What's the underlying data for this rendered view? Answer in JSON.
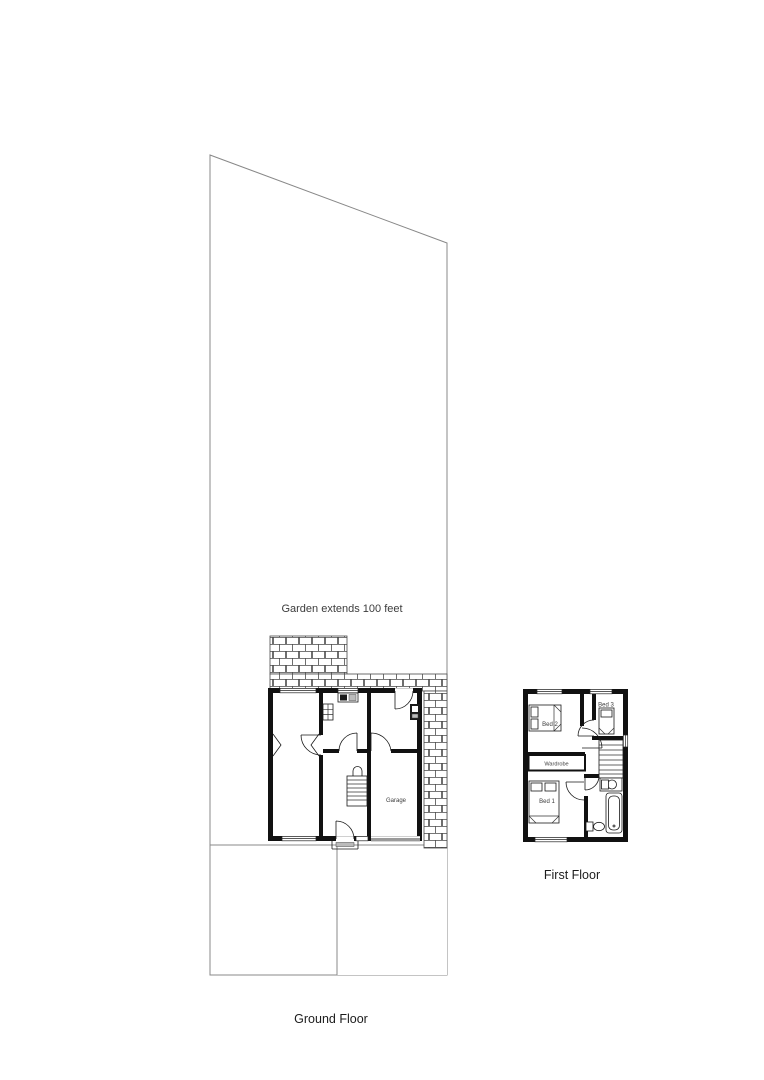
{
  "document": {
    "type": "property-floorplan",
    "background": "#ffffff"
  },
  "colors": {
    "wall": "#111111",
    "boundary": "#888888",
    "garage_door": "#9a9a9a",
    "label": "#3c3c3c",
    "title": "#1c1c1c"
  },
  "site_plan": {
    "garden_label": "Garden extends 100 feet",
    "floor_label": "Ground Floor",
    "rooms": {
      "garage": "Garage"
    }
  },
  "first_floor_plan": {
    "floor_label": "First Floor",
    "rooms": {
      "bed1": "Bed 1",
      "bed2": "Bed 2",
      "bed3": "Bed 3",
      "wardrobe": "Wardrobe"
    }
  }
}
